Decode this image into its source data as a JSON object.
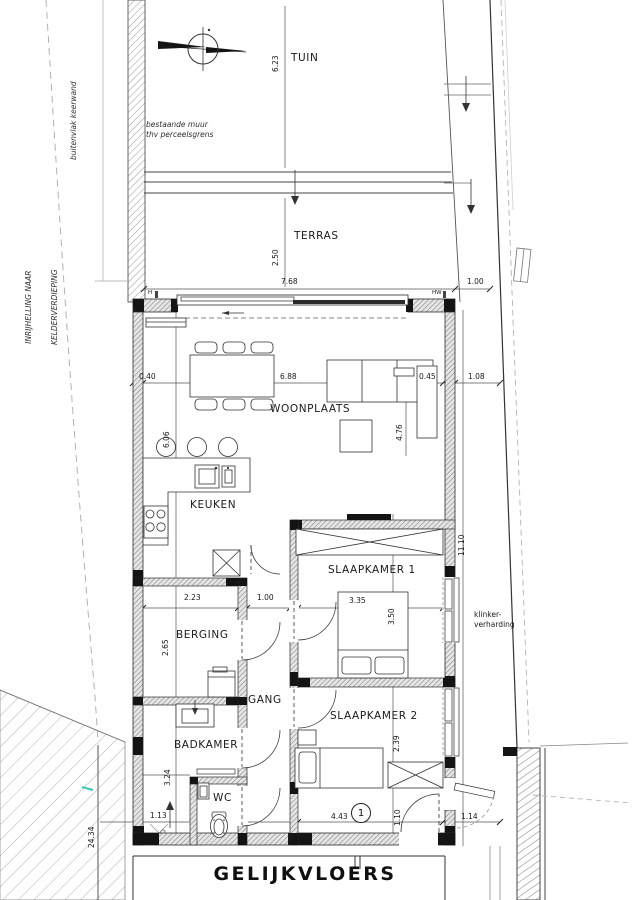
{
  "title": "GELIJKVLOERS",
  "colors": {
    "paper": "#ffffff",
    "line": "#2b2b2b",
    "wall_hatch": "#8d8d8d",
    "black_pier": "#141414",
    "site_line": "#9a9a9a",
    "accent_teal": "#3cc8b8"
  },
  "site": {
    "tuin": "TUIN",
    "terras": "TERRAS",
    "note_existing_1": "bestaande muur",
    "note_existing_2": "thv perceelsgrens",
    "note_keerwand": "buitenvlak keerwand",
    "note_ramp_1": "INRIJHELLING NAAR",
    "note_ramp_2": "KELDERVERDIEPING",
    "note_paving_1": "klinker-",
    "note_paving_2": "verharding",
    "marker_h": "H",
    "marker_hw": "HW"
  },
  "rooms": {
    "woonplaats": "WOONPLAATS",
    "keuken": "KEUKEN",
    "slaapkamer1": "SLAAPKAMER 1",
    "slaapkamer2": "SLAAPKAMER 2",
    "berging": "BERGING",
    "gang": "GANG",
    "badkamer": "BADKAMER",
    "wc": "WC"
  },
  "dims": {
    "tuin_depth": "6.23",
    "terras_depth": "2.50",
    "front_width": "7.68",
    "side_offset": "1.00",
    "wall_040": "0.40",
    "inner_width": "6.88",
    "wall_045": "0.45",
    "side_108": "1.08",
    "keuken_length": "6.06",
    "living_depth": "4.76",
    "house_length": "11.10",
    "berging_width": "2.23",
    "gang_width": "1.00",
    "bed1_width": "3.35",
    "bed1_depth": "3.50",
    "berging_depth": "2.65",
    "bed2_depth": "2.39",
    "badkamer_depth": "3.24",
    "wc_width": "1.13",
    "entry_width": "4.43",
    "entry_depth": "1.10",
    "entry_side": "1.14",
    "site_length": "24.34"
  },
  "tags": {
    "door_number": "1"
  }
}
